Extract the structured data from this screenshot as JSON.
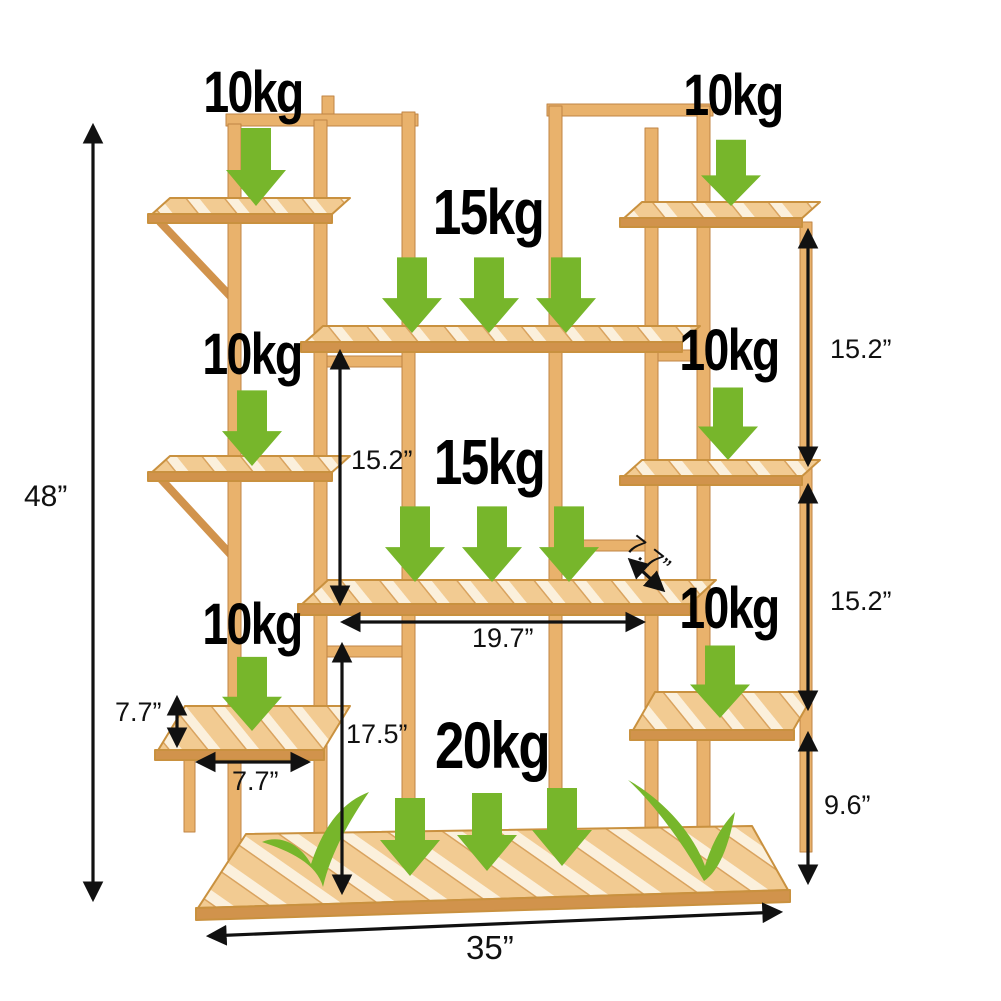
{
  "colors": {
    "arrow_green": "#77B62B",
    "dimension": "#111111",
    "label_black": "#000000",
    "bamboo_light": "#F2CB92",
    "bamboo_mid": "#E9B26C",
    "bamboo_dark": "#D1934C",
    "background": "#FFFFFF"
  },
  "icons": {
    "load_arrow": "down-arrow",
    "approved_mark": "checkmark"
  },
  "weights": [
    {
      "id": "top-left",
      "label": "10kg"
    },
    {
      "id": "top-right",
      "label": "10kg"
    },
    {
      "id": "upper-center",
      "label": "15kg"
    },
    {
      "id": "mid-left",
      "label": "10kg"
    },
    {
      "id": "mid-right",
      "label": "10kg"
    },
    {
      "id": "center",
      "label": "15kg"
    },
    {
      "id": "lower-left",
      "label": "10kg"
    },
    {
      "id": "lower-right",
      "label": "10kg"
    },
    {
      "id": "bottom",
      "label": "20kg"
    }
  ],
  "dimensions": {
    "overall_height": "48”",
    "upper_right_gap": "15.2”",
    "middle_right_gap": "15.2”",
    "base_height": "9.6”",
    "center_tier_gap": "15.2”",
    "depth_diagonal": "7.7”",
    "center_shelf_width": "19.7”",
    "side_shelf_height": "7.7”",
    "side_shelf_width": "7.7”",
    "lower_center_gap": "17.5”",
    "overall_width": "35”"
  }
}
